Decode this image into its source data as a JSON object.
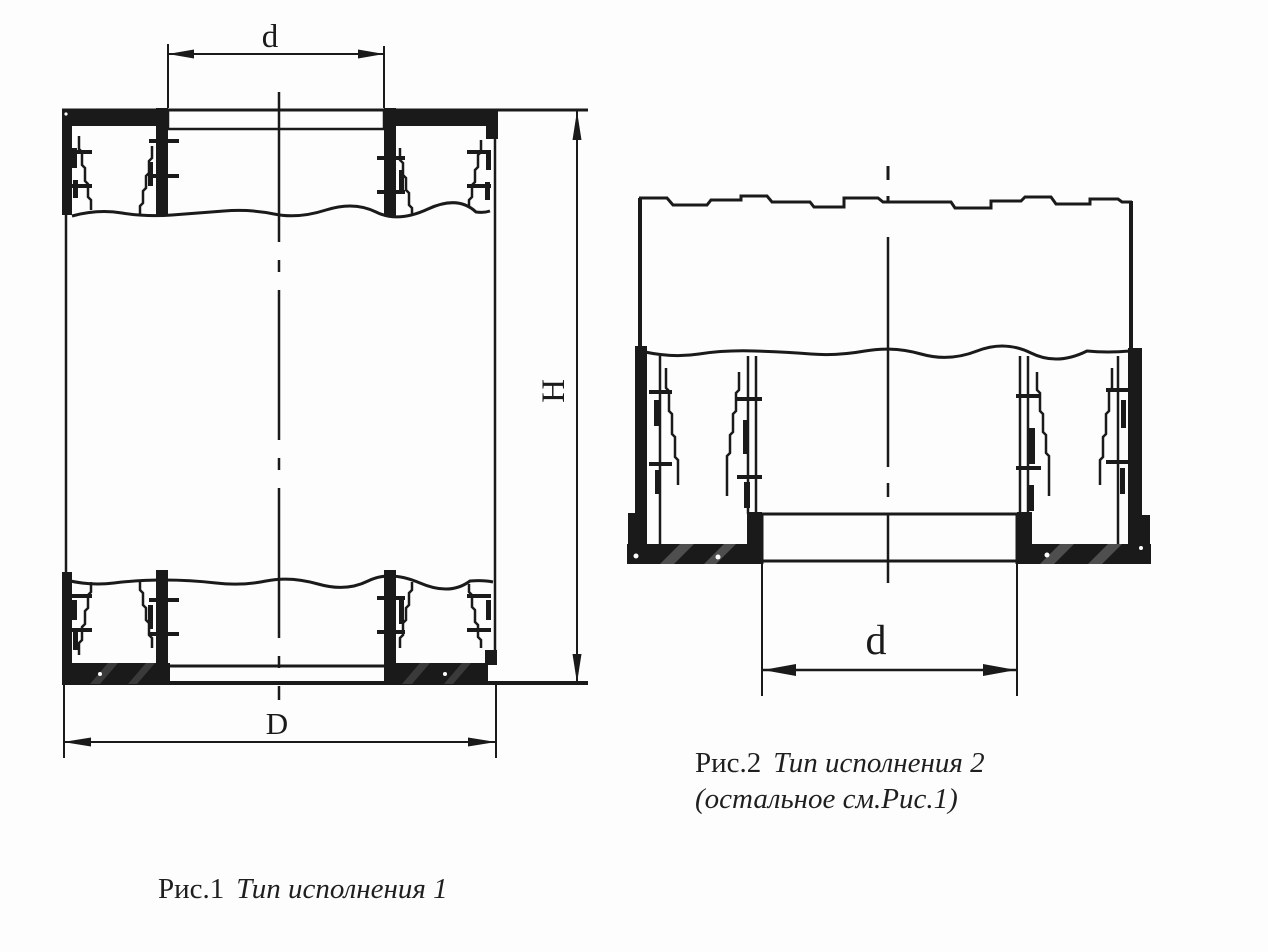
{
  "figures": {
    "fig1": {
      "dimensions": {
        "inner_diameter": "d",
        "outer_diameter": "D",
        "height": "H"
      },
      "caption": {
        "label": "Рис.1",
        "title": "Тип исполнения 1"
      }
    },
    "fig2": {
      "dimensions": {
        "inner_diameter": "d"
      },
      "caption": {
        "label": "Рис.2",
        "title": "Тип исполнения 2",
        "note": "(остальное см.Рис.1)"
      }
    }
  },
  "colors": {
    "ink": "#1a1a1a",
    "paper": "#fdfdfd",
    "watermark": "#8e8e8e"
  }
}
